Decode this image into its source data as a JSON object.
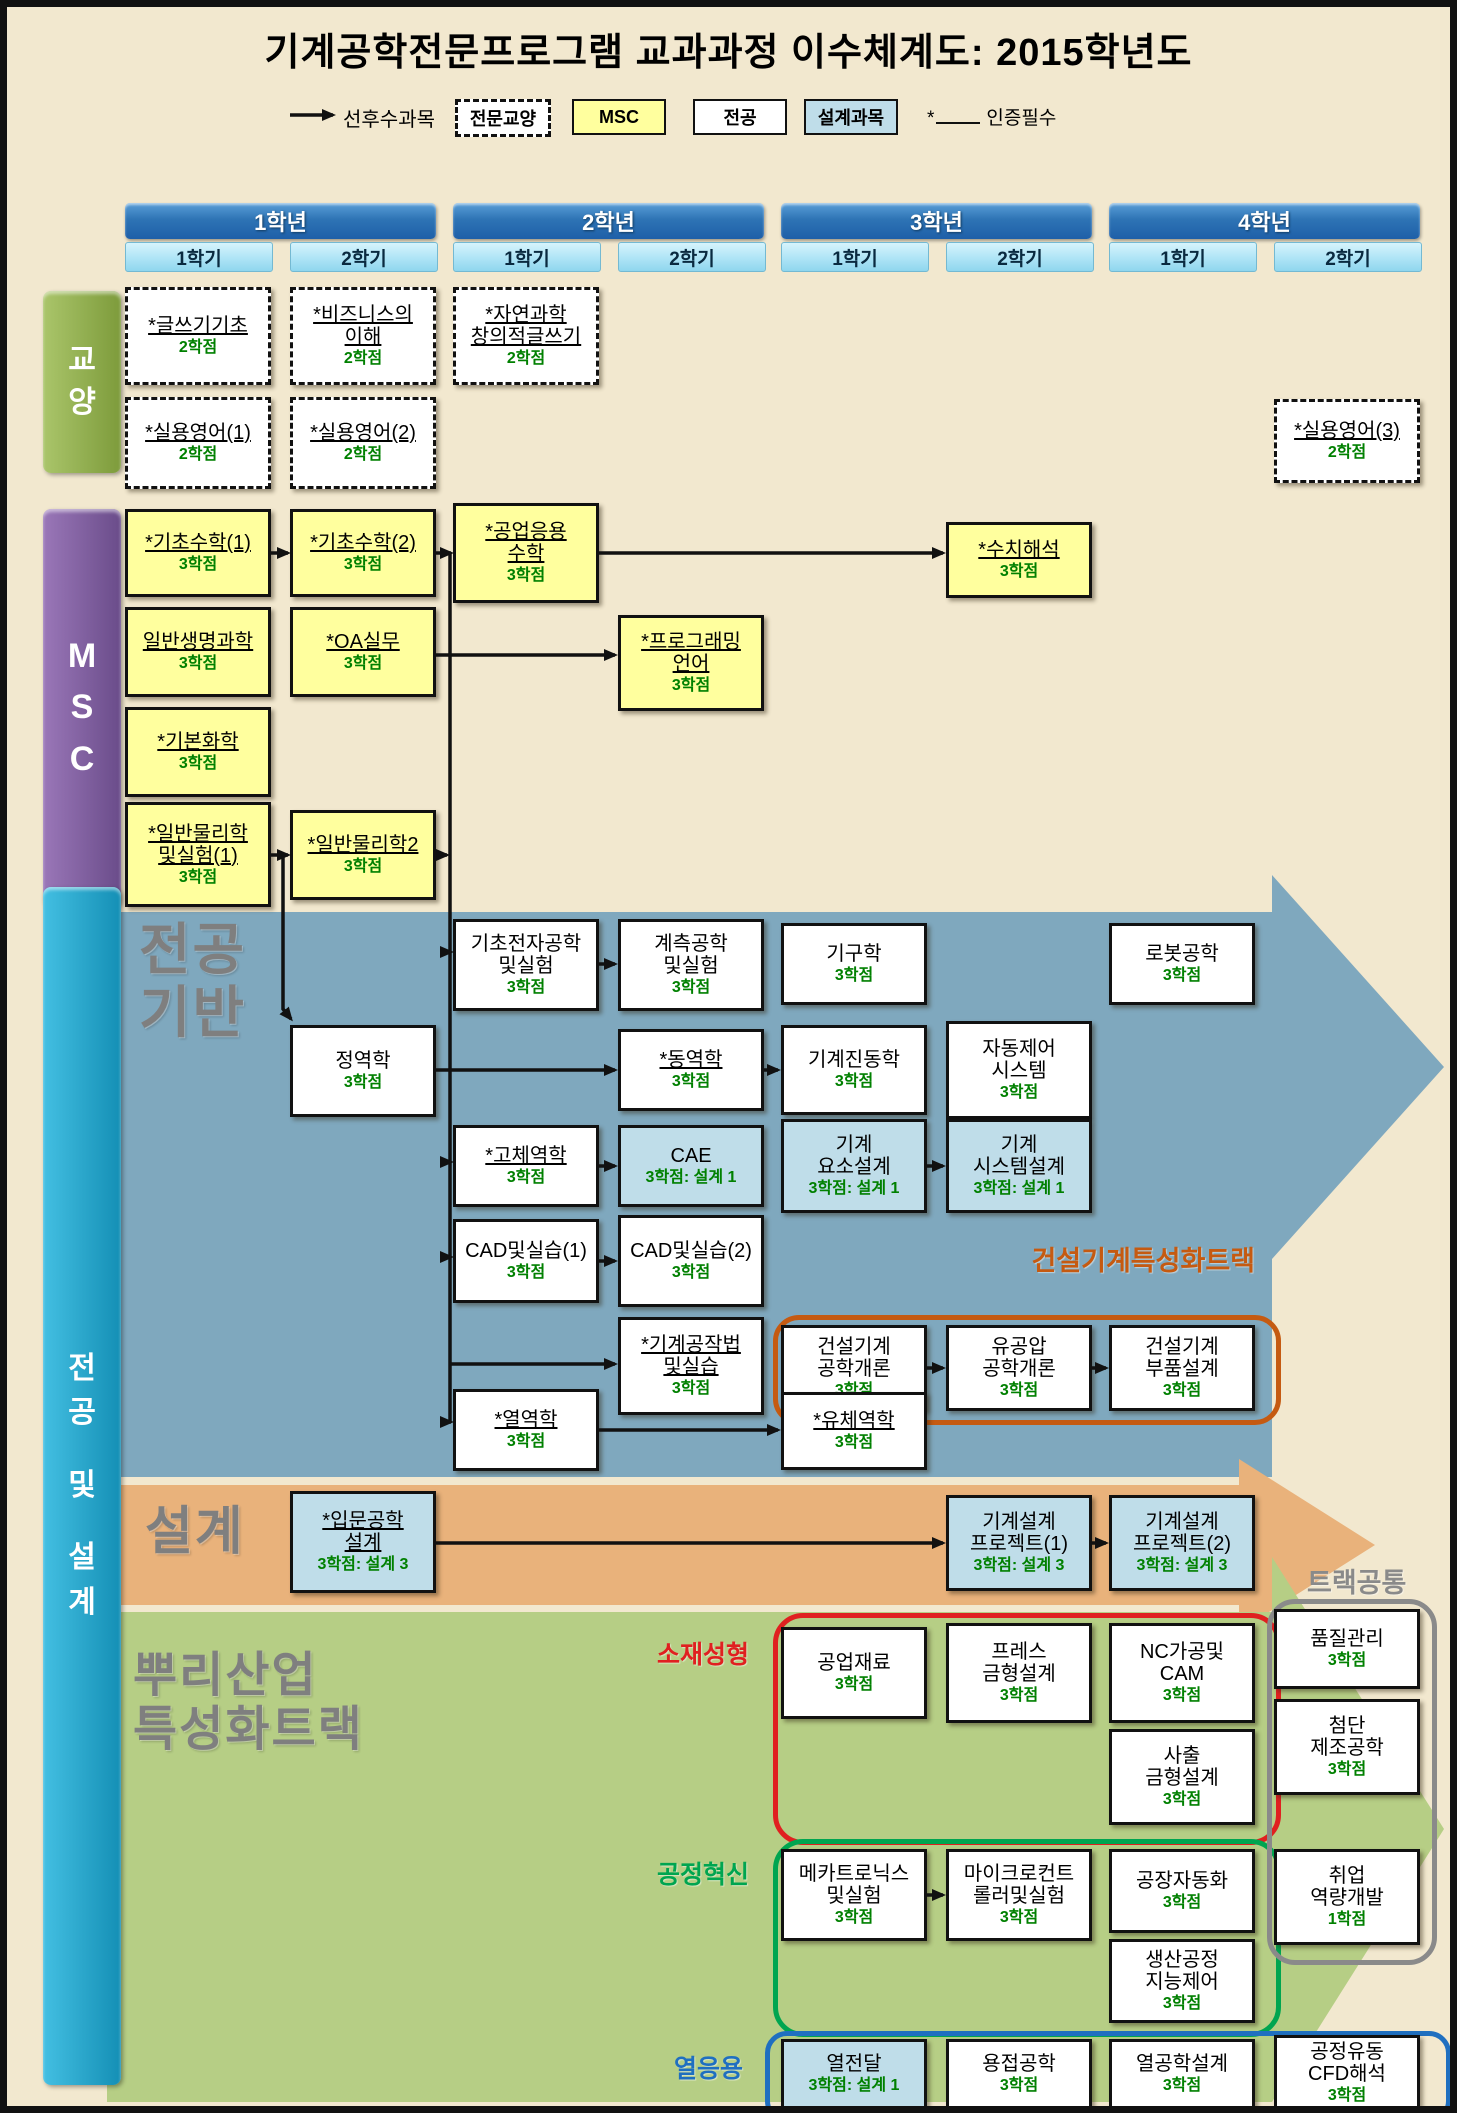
{
  "title": "기계공학전문프로그램 교과과정 이수체계도: 2015학년도",
  "legend": {
    "arrow_label": "선후수과목",
    "items": [
      {
        "label": "전문교양",
        "type": "dashed",
        "x": 448
      },
      {
        "label": "MSC",
        "type": "msc",
        "x": 565
      },
      {
        "label": "전공",
        "type": "white",
        "x": 686
      },
      {
        "label": "설계과목",
        "type": "design",
        "x": 797
      }
    ],
    "required_mark": "*",
    "required_label": "인증필수"
  },
  "grid": {
    "cols": [
      118,
      283,
      446,
      611,
      774,
      939,
      1102,
      1267
    ],
    "box_w": 146
  },
  "years": [
    {
      "label": "1학년",
      "semesters": [
        "1학기",
        "2학기"
      ]
    },
    {
      "label": "2학년",
      "semesters": [
        "1학기",
        "2학기"
      ]
    },
    {
      "label": "3학년",
      "semesters": [
        "1학기",
        "2학기"
      ]
    },
    {
      "label": "4학년",
      "semesters": [
        "1학기",
        "2학기"
      ]
    }
  ],
  "bars": [
    {
      "id": "gyoyang",
      "chars": [
        "교",
        "양"
      ],
      "x": 36,
      "y": 284,
      "w": 78,
      "h": 182,
      "c1": "#aac56a",
      "c2": "#7d9b3b",
      "gap": 8,
      "fs": 30
    },
    {
      "id": "msc",
      "chars": [
        "M",
        "S",
        "C"
      ],
      "x": 36,
      "y": 502,
      "w": 78,
      "h": 398,
      "c1": "#9a77b8",
      "c2": "#6a4c8a",
      "gap": 12,
      "fs": 34
    },
    {
      "id": "major-design",
      "chars": [
        "전",
        "공",
        "",
        "및",
        "",
        "설",
        "계"
      ],
      "x": 36,
      "y": 880,
      "w": 78,
      "h": 1198,
      "c1": "#43bfe2",
      "c2": "#148fb5",
      "gap": 10,
      "fs": 30
    }
  ],
  "band_labels": [
    {
      "id": "major-base",
      "lines": [
        "전공",
        "기반"
      ],
      "x": 132,
      "y": 912,
      "size": 56
    },
    {
      "id": "design",
      "lines": [
        "설계"
      ],
      "x": 138,
      "y": 1496,
      "size": 52
    },
    {
      "id": "root-track",
      "lines": [
        "뿌리산업",
        "특성화트랙"
      ],
      "x": 126,
      "y": 1642,
      "size": 48
    }
  ],
  "tracks": [
    {
      "id": "construction-track",
      "x": 766,
      "y": 1308,
      "w": 498,
      "h": 100,
      "r": 26,
      "color_key": "track_construction"
    },
    {
      "id": "material-forming",
      "x": 766,
      "y": 1606,
      "w": 498,
      "h": 222,
      "r": 30,
      "color_key": "track_material"
    },
    {
      "id": "process-innovation",
      "x": 766,
      "y": 1832,
      "w": 498,
      "h": 188,
      "r": 30,
      "color_key": "track_process"
    },
    {
      "id": "track-common",
      "x": 1260,
      "y": 1592,
      "w": 160,
      "h": 356,
      "r": 28,
      "color_key": "track_common"
    },
    {
      "id": "thermal",
      "x": 758,
      "y": 2024,
      "w": 676,
      "h": 82,
      "r": 22,
      "color_key": "track_thermal"
    }
  ],
  "track_labels": [
    {
      "id": "construction-track-label",
      "text": "건설기계특성화트랙",
      "x": 1262,
      "y": 1232,
      "size": 27,
      "align": "right",
      "color_key": "track_construction"
    },
    {
      "id": "material-forming-label",
      "text": "소재성형",
      "x": 756,
      "y": 1628,
      "size": 25,
      "align": "right",
      "color_key": "track_material"
    },
    {
      "id": "process-innovation-label",
      "text": "공정혁신",
      "x": 756,
      "y": 1848,
      "size": 25,
      "align": "right",
      "color_key": "track_process"
    },
    {
      "id": "thermal-label",
      "text": "열응용",
      "x": 750,
      "y": 2042,
      "size": 25,
      "align": "right",
      "color_key": "track_thermal"
    },
    {
      "id": "track-common-label",
      "text": "트랙공통",
      "x": 1300,
      "y": 1554,
      "size": 27,
      "align": "left",
      "color_key": "track_common"
    }
  ],
  "colors": {
    "background": "#F2E8CF",
    "band_major": "#7FA8BE",
    "band_design": "#E9B27B",
    "band_root": "#B6CE85",
    "msc_box": "#FFFF9E",
    "design_box": "#BFDDE9",
    "credit_green": "#008000",
    "track_construction": "#C55A11",
    "track_material": "#E02020",
    "track_process": "#00A550",
    "track_thermal": "#1F6FC0",
    "track_common": "#8A8A8A"
  },
  "courses": [
    {
      "id": "writing",
      "name": [
        "*글쓰기기초"
      ],
      "credit": "2학점",
      "col": 1,
      "top": 280,
      "h": 98,
      "type": "dashed",
      "u": true
    },
    {
      "id": "business",
      "name": [
        "*비즈니스의",
        "이해"
      ],
      "credit": "2학점",
      "col": 2,
      "top": 280,
      "h": 98,
      "type": "dashed",
      "u": true
    },
    {
      "id": "natsci-writing",
      "name": [
        "*자연과학",
        "창의적글쓰기"
      ],
      "credit": "2학점",
      "col": 3,
      "top": 280,
      "h": 98,
      "type": "dashed",
      "u": true
    },
    {
      "id": "english1",
      "name": [
        "*실용영어(1)"
      ],
      "credit": "2학점",
      "col": 1,
      "top": 390,
      "h": 92,
      "type": "dashed",
      "u": true
    },
    {
      "id": "english2",
      "name": [
        "*실용영어(2)"
      ],
      "credit": "2학점",
      "col": 2,
      "top": 390,
      "h": 92,
      "type": "dashed",
      "u": true
    },
    {
      "id": "english3",
      "name": [
        "*실용영어(3)"
      ],
      "credit": "2학점",
      "col": 8,
      "top": 392,
      "h": 84,
      "type": "dashed",
      "u": true
    },
    {
      "id": "math1",
      "name": [
        "*기초수학(1)"
      ],
      "credit": "3학점",
      "col": 1,
      "top": 502,
      "h": 88,
      "type": "msc",
      "u": true
    },
    {
      "id": "math2",
      "name": [
        "*기초수학(2)"
      ],
      "credit": "3학점",
      "col": 2,
      "top": 502,
      "h": 88,
      "type": "msc",
      "u": true
    },
    {
      "id": "eng-math",
      "name": [
        "*공업응용",
        "수학"
      ],
      "credit": "3학점",
      "col": 3,
      "top": 496,
      "h": 100,
      "type": "msc",
      "u": true
    },
    {
      "id": "numerical",
      "name": [
        "*수치해석"
      ],
      "credit": "3학점",
      "col": 6,
      "top": 515,
      "h": 76,
      "type": "msc",
      "u": true
    },
    {
      "id": "biology",
      "name": [
        "일반생명과학"
      ],
      "credit": "3학점",
      "col": 1,
      "top": 600,
      "h": 90,
      "type": "msc",
      "u": true
    },
    {
      "id": "oa",
      "name": [
        "*OA실무"
      ],
      "credit": "3학점",
      "col": 2,
      "top": 600,
      "h": 90,
      "type": "msc",
      "u": true
    },
    {
      "id": "programming",
      "name": [
        "*프로그래밍",
        "언어"
      ],
      "credit": "3학점",
      "col": 4,
      "top": 608,
      "h": 96,
      "type": "msc",
      "u": true
    },
    {
      "id": "chemistry",
      "name": [
        "*기본화학"
      ],
      "credit": "3학점",
      "col": 1,
      "top": 700,
      "h": 90,
      "type": "msc",
      "u": true
    },
    {
      "id": "physics1",
      "name": [
        "*일반물리학",
        "및실험(1)"
      ],
      "credit": "3학점",
      "col": 1,
      "top": 795,
      "h": 105,
      "type": "msc",
      "u": true
    },
    {
      "id": "physics2",
      "name": [
        "*일반물리학2"
      ],
      "credit": "3학점",
      "col": 2,
      "top": 803,
      "h": 90,
      "type": "msc",
      "u": true
    },
    {
      "id": "electronics",
      "name": [
        "기초전자공학",
        "및실험"
      ],
      "credit": "3학점",
      "col": 3,
      "top": 912,
      "h": 92,
      "type": "white",
      "u": false
    },
    {
      "id": "measurement",
      "name": [
        "계측공학",
        "및실험"
      ],
      "credit": "3학점",
      "col": 4,
      "top": 912,
      "h": 92,
      "type": "white",
      "u": false
    },
    {
      "id": "mechanism",
      "name": [
        "기구학"
      ],
      "credit": "3학점",
      "col": 5,
      "top": 916,
      "h": 82,
      "type": "white",
      "u": false
    },
    {
      "id": "robotics",
      "name": [
        "로봇공학"
      ],
      "credit": "3학점",
      "col": 7,
      "top": 916,
      "h": 82,
      "type": "white",
      "u": false
    },
    {
      "id": "statics",
      "name": [
        "정역학"
      ],
      "credit": "3학점",
      "col": 2,
      "top": 1018,
      "h": 92,
      "type": "white",
      "u": false
    },
    {
      "id": "dynamics",
      "name": [
        "*동역학"
      ],
      "credit": "3학점",
      "col": 4,
      "top": 1022,
      "h": 82,
      "type": "white",
      "u": true
    },
    {
      "id": "vibration",
      "name": [
        "기계진동학"
      ],
      "credit": "3학점",
      "col": 5,
      "top": 1018,
      "h": 90,
      "type": "white",
      "u": false
    },
    {
      "id": "auto-control",
      "name": [
        "자동제어",
        "시스템"
      ],
      "credit": "3학점",
      "col": 6,
      "top": 1014,
      "h": 98,
      "type": "white",
      "u": false
    },
    {
      "id": "solid-mech",
      "name": [
        "*고체역학"
      ],
      "credit": "3학점",
      "col": 3,
      "top": 1118,
      "h": 82,
      "type": "white",
      "u": true
    },
    {
      "id": "cae",
      "name": [
        "CAE"
      ],
      "credit": "3학점: 설계 1",
      "col": 4,
      "top": 1118,
      "h": 82,
      "type": "design",
      "u": false
    },
    {
      "id": "machine-elements",
      "name": [
        "기계",
        "요소설계"
      ],
      "credit": "3학점: 설계 1",
      "col": 5,
      "top": 1112,
      "h": 94,
      "type": "design",
      "u": false
    },
    {
      "id": "machine-system",
      "name": [
        "기계",
        "시스템설계"
      ],
      "credit": "3학점: 설계 1",
      "col": 6,
      "top": 1112,
      "h": 94,
      "type": "design",
      "u": false
    },
    {
      "id": "cad1",
      "name": [
        "CAD및실습(1)"
      ],
      "credit": "3학점",
      "col": 3,
      "top": 1212,
      "h": 84,
      "type": "white",
      "u": false
    },
    {
      "id": "cad2",
      "name": [
        "CAD및실습(2)"
      ],
      "credit": "3학점",
      "col": 4,
      "top": 1208,
      "h": 92,
      "type": "white",
      "u": false
    },
    {
      "id": "machining",
      "name": [
        "*기계공작법",
        "및실습"
      ],
      "credit": "3학점",
      "col": 4,
      "top": 1310,
      "h": 98,
      "type": "white",
      "u": true
    },
    {
      "id": "construction-intro",
      "name": [
        "건설기계",
        "공학개론"
      ],
      "credit": "3학점",
      "col": 5,
      "top": 1318,
      "h": 86,
      "type": "white",
      "u": false
    },
    {
      "id": "hydraulics",
      "name": [
        "유공압",
        "공학개론"
      ],
      "credit": "3학점",
      "col": 6,
      "top": 1318,
      "h": 86,
      "type": "white",
      "u": false
    },
    {
      "id": "construction-parts",
      "name": [
        "건설기계",
        "부품설계"
      ],
      "credit": "3학점",
      "col": 7,
      "top": 1318,
      "h": 86,
      "type": "white",
      "u": false
    },
    {
      "id": "thermodynamics",
      "name": [
        "*열역학"
      ],
      "credit": "3학점",
      "col": 3,
      "top": 1382,
      "h": 82,
      "type": "white",
      "u": true
    },
    {
      "id": "fluid-mech",
      "name": [
        "*유체역학"
      ],
      "credit": "3학점",
      "col": 5,
      "top": 1385,
      "h": 78,
      "type": "white",
      "u": true
    },
    {
      "id": "intro-design",
      "name": [
        "*입문공학",
        "설계"
      ],
      "credit": "3학점: 설계 3",
      "col": 2,
      "top": 1484,
      "h": 102,
      "type": "design",
      "u": true
    },
    {
      "id": "design-project1",
      "name": [
        "기계설계",
        "프로젝트(1)"
      ],
      "credit": "3학점: 설계 3",
      "col": 6,
      "top": 1488,
      "h": 96,
      "type": "design",
      "u": false
    },
    {
      "id": "design-project2",
      "name": [
        "기계설계",
        "프로젝트(2)"
      ],
      "credit": "3학점: 설계 3",
      "col": 7,
      "top": 1488,
      "h": 96,
      "type": "design",
      "u": false
    },
    {
      "id": "materials",
      "name": [
        "공업재료"
      ],
      "credit": "3학점",
      "col": 5,
      "top": 1620,
      "h": 92,
      "type": "white",
      "u": false
    },
    {
      "id": "press-die",
      "name": [
        "프레스",
        "금형설계"
      ],
      "credit": "3학점",
      "col": 6,
      "top": 1616,
      "h": 100,
      "type": "white",
      "u": false
    },
    {
      "id": "nc-cam",
      "name": [
        "NC가공및",
        "CAM"
      ],
      "credit": "3학점",
      "col": 7,
      "top": 1616,
      "h": 100,
      "type": "white",
      "u": false
    },
    {
      "id": "injection-die",
      "name": [
        "사출",
        "금형설계"
      ],
      "credit": "3학점",
      "col": 7,
      "top": 1722,
      "h": 96,
      "type": "white",
      "u": false
    },
    {
      "id": "quality",
      "name": [
        "품질관리"
      ],
      "credit": "3학점",
      "col": 8,
      "top": 1602,
      "h": 80,
      "type": "white",
      "u": false
    },
    {
      "id": "adv-manufacturing",
      "name": [
        "첨단",
        "제조공학"
      ],
      "credit": "3학점",
      "col": 8,
      "top": 1692,
      "h": 96,
      "type": "white",
      "u": false
    },
    {
      "id": "career",
      "name": [
        "취업",
        "역량개발"
      ],
      "credit": "1학점",
      "col": 8,
      "top": 1842,
      "h": 96,
      "type": "white",
      "u": false
    },
    {
      "id": "mechatronics",
      "name": [
        "메카트로닉스",
        "및실험"
      ],
      "credit": "3학점",
      "col": 5,
      "top": 1842,
      "h": 92,
      "type": "white",
      "u": false
    },
    {
      "id": "microcontroller",
      "name": [
        "마이크로컨트",
        "롤러및실험"
      ],
      "credit": "3학점",
      "col": 6,
      "top": 1842,
      "h": 92,
      "type": "white",
      "u": false
    },
    {
      "id": "factory-automation",
      "name": [
        "공장자동화"
      ],
      "credit": "3학점",
      "col": 7,
      "top": 1842,
      "h": 84,
      "type": "white",
      "u": false
    },
    {
      "id": "production-control",
      "name": [
        "생산공정",
        "지능제어"
      ],
      "credit": "3학점",
      "col": 7,
      "top": 1932,
      "h": 84,
      "type": "white",
      "u": false
    },
    {
      "id": "heat-transfer",
      "name": [
        "열전달"
      ],
      "credit": "3학점: 설계 1",
      "col": 5,
      "top": 2032,
      "h": 70,
      "type": "design",
      "u": false
    },
    {
      "id": "welding",
      "name": [
        "용접공학"
      ],
      "credit": "3학점",
      "col": 6,
      "top": 2032,
      "h": 70,
      "type": "white",
      "u": false
    },
    {
      "id": "thermal-design",
      "name": [
        "열공학설계"
      ],
      "credit": "3학점",
      "col": 7,
      "top": 2032,
      "h": 70,
      "type": "white",
      "u": false
    },
    {
      "id": "cfd",
      "name": [
        "공정유동",
        "CFD해석"
      ],
      "credit": "3학점",
      "col": 8,
      "top": 2028,
      "h": 76,
      "type": "white",
      "u": false
    }
  ],
  "connectors": [
    {
      "pts": [
        [
          283,
          108
        ],
        [
          326,
          108
        ]
      ],
      "a": 1
    },
    {
      "pts": [
        [
          264,
          546
        ],
        [
          281,
          546
        ]
      ],
      "a": 1
    },
    {
      "pts": [
        [
          429,
          546
        ],
        [
          444,
          546
        ]
      ],
      "a": 1
    },
    {
      "pts": [
        [
          592,
          546
        ],
        [
          936,
          546
        ]
      ],
      "a": 1
    },
    {
      "pts": [
        [
          429,
          648
        ],
        [
          608,
          648
        ]
      ],
      "a": 1
    },
    {
      "pts": [
        [
          264,
          848
        ],
        [
          281,
          848
        ]
      ],
      "a": 1
    },
    {
      "pts": [
        [
          429,
          848
        ],
        [
          440,
          848
        ]
      ],
      "a": 1
    },
    {
      "pts": [
        [
          443,
          546
        ],
        [
          443,
          1415
        ]
      ],
      "a": 0
    },
    {
      "pts": [
        [
          436,
          945
        ],
        [
          444,
          945
        ]
      ],
      "a": 1
    },
    {
      "pts": [
        [
          436,
          1155
        ],
        [
          444,
          1155
        ]
      ],
      "a": 1
    },
    {
      "pts": [
        [
          436,
          1250
        ],
        [
          444,
          1250
        ]
      ],
      "a": 1
    },
    {
      "pts": [
        [
          443,
          1357
        ],
        [
          608,
          1357
        ]
      ],
      "a": 1
    },
    {
      "pts": [
        [
          436,
          1415
        ],
        [
          444,
          1415
        ]
      ],
      "a": 1
    },
    {
      "pts": [
        [
          276,
          848
        ],
        [
          276,
          1002
        ],
        [
          284,
          1012
        ]
      ],
      "a": 1
    },
    {
      "pts": [
        [
          429,
          1063
        ],
        [
          608,
          1063
        ]
      ],
      "a": 1
    },
    {
      "pts": [
        [
          757,
          1063
        ],
        [
          771,
          1063
        ]
      ],
      "a": 1
    },
    {
      "pts": [
        [
          592,
          957
        ],
        [
          608,
          957
        ]
      ],
      "a": 1
    },
    {
      "pts": [
        [
          592,
          1159
        ],
        [
          608,
          1159
        ]
      ],
      "a": 1
    },
    {
      "pts": [
        [
          920,
          1159
        ],
        [
          936,
          1159
        ]
      ],
      "a": 1
    },
    {
      "pts": [
        [
          592,
          1254
        ],
        [
          608,
          1254
        ]
      ],
      "a": 1
    },
    {
      "pts": [
        [
          592,
          1423
        ],
        [
          771,
          1423
        ]
      ],
      "a": 1
    },
    {
      "pts": [
        [
          920,
          1361
        ],
        [
          936,
          1361
        ]
      ],
      "a": 1
    },
    {
      "pts": [
        [
          1085,
          1361
        ],
        [
          1099,
          1361
        ]
      ],
      "a": 1
    },
    {
      "pts": [
        [
          429,
          1536
        ],
        [
          936,
          1536
        ]
      ],
      "a": 1
    },
    {
      "pts": [
        [
          1085,
          1536
        ],
        [
          1099,
          1536
        ]
      ],
      "a": 1
    },
    {
      "pts": [
        [
          920,
          1888
        ],
        [
          936,
          1888
        ]
      ],
      "a": 1
    }
  ]
}
